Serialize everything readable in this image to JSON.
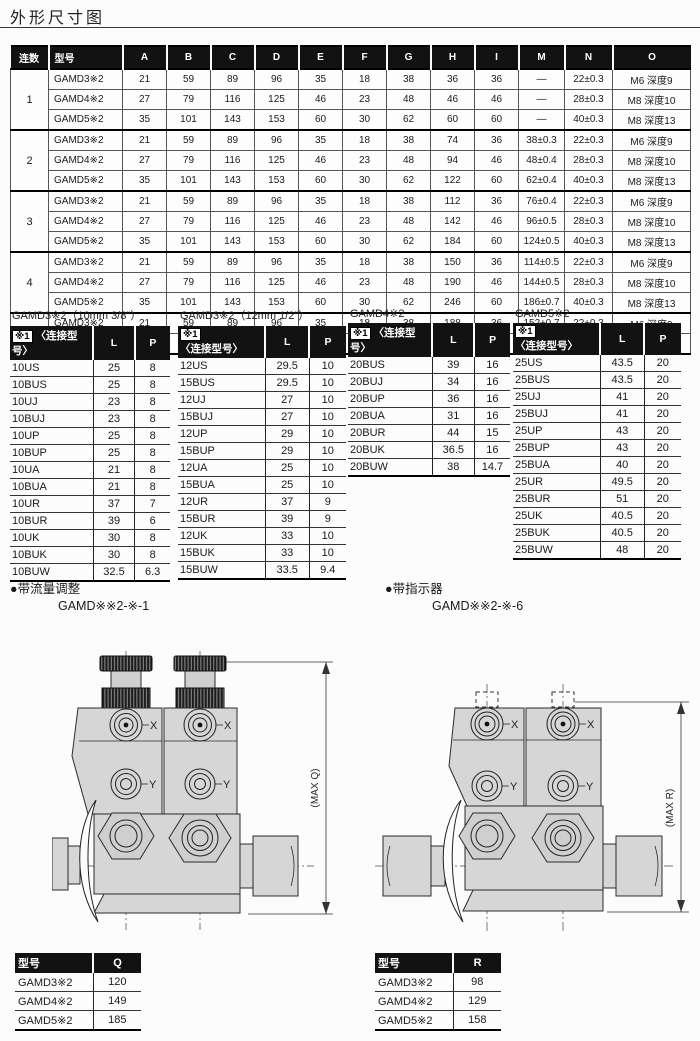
{
  "page": {
    "title": "外形尺寸图"
  },
  "main_table": {
    "headers": [
      "连数",
      "型号",
      "A",
      "B",
      "C",
      "D",
      "E",
      "F",
      "G",
      "H",
      "I",
      "M",
      "N",
      "O"
    ],
    "groups": [
      {
        "count": "1",
        "rows": [
          [
            "GAMD3※2",
            "21",
            "59",
            "89",
            "96",
            "35",
            "18",
            "38",
            "36",
            "36",
            "—",
            "22±0.3",
            "M6  深度9"
          ],
          [
            "GAMD4※2",
            "27",
            "79",
            "116",
            "125",
            "46",
            "23",
            "48",
            "46",
            "46",
            "—",
            "28±0.3",
            "M8  深度10"
          ],
          [
            "GAMD5※2",
            "35",
            "101",
            "143",
            "153",
            "60",
            "30",
            "62",
            "60",
            "60",
            "—",
            "40±0.3",
            "M8  深度13"
          ]
        ]
      },
      {
        "count": "2",
        "rows": [
          [
            "GAMD3※2",
            "21",
            "59",
            "89",
            "96",
            "35",
            "18",
            "38",
            "74",
            "36",
            "38±0.3",
            "22±0.3",
            "M6  深度9"
          ],
          [
            "GAMD4※2",
            "27",
            "79",
            "116",
            "125",
            "46",
            "23",
            "48",
            "94",
            "46",
            "48±0.4",
            "28±0.3",
            "M8  深度10"
          ],
          [
            "GAMD5※2",
            "35",
            "101",
            "143",
            "153",
            "60",
            "30",
            "62",
            "122",
            "60",
            "62±0.4",
            "40±0.3",
            "M8  深度13"
          ]
        ]
      },
      {
        "count": "3",
        "rows": [
          [
            "GAMD3※2",
            "21",
            "59",
            "89",
            "96",
            "35",
            "18",
            "38",
            "112",
            "36",
            "76±0.4",
            "22±0.3",
            "M6  深度9"
          ],
          [
            "GAMD4※2",
            "27",
            "79",
            "116",
            "125",
            "46",
            "23",
            "48",
            "142",
            "46",
            "96±0.5",
            "28±0.3",
            "M8  深度10"
          ],
          [
            "GAMD5※2",
            "35",
            "101",
            "143",
            "153",
            "60",
            "30",
            "62",
            "184",
            "60",
            "124±0.5",
            "40±0.3",
            "M8  深度13"
          ]
        ]
      },
      {
        "count": "4",
        "rows": [
          [
            "GAMD3※2",
            "21",
            "59",
            "89",
            "96",
            "35",
            "18",
            "38",
            "150",
            "36",
            "114±0.5",
            "22±0.3",
            "M6  深度9"
          ],
          [
            "GAMD4※2",
            "27",
            "79",
            "116",
            "125",
            "46",
            "23",
            "48",
            "190",
            "46",
            "144±0.5",
            "28±0.3",
            "M8  深度10"
          ],
          [
            "GAMD5※2",
            "35",
            "101",
            "143",
            "153",
            "60",
            "30",
            "62",
            "246",
            "60",
            "186±0.7",
            "40±0.3",
            "M8  深度13"
          ]
        ]
      },
      {
        "count": "5",
        "rows": [
          [
            "GAMD3※2",
            "21",
            "59",
            "89",
            "96",
            "35",
            "18",
            "38",
            "188",
            "36",
            "152±0.7",
            "22±0.3",
            "M6  深度9"
          ],
          [
            "GAMD4※2",
            "27",
            "79",
            "116",
            "125",
            "46",
            "23",
            "48",
            "238",
            "46",
            "192±0.7",
            "28±0.3",
            "M8  深度10"
          ]
        ]
      }
    ]
  },
  "sub_tables": [
    {
      "title": "GAMD3※2（10mm 3/8\"）",
      "ref": "※1",
      "header": "〈连接型号〉",
      "col_l": "L",
      "col_p": "P",
      "rows": [
        [
          "10US",
          "25",
          "8"
        ],
        [
          "10BUS",
          "25",
          "8"
        ],
        [
          "10UJ",
          "23",
          "8"
        ],
        [
          "10BUJ",
          "23",
          "8"
        ],
        [
          "10UP",
          "25",
          "8"
        ],
        [
          "10BUP",
          "25",
          "8"
        ],
        [
          "10UA",
          "21",
          "8"
        ],
        [
          "10BUA",
          "21",
          "8"
        ],
        [
          "10UR",
          "37",
          "7"
        ],
        [
          "10BUR",
          "39",
          "6"
        ],
        [
          "10UK",
          "30",
          "8"
        ],
        [
          "10BUK",
          "30",
          "8"
        ],
        [
          "10BUW",
          "32.5",
          "6.3"
        ]
      ]
    },
    {
      "title": "GAMD3※2（12mm 1/2\"）",
      "ref": "※1",
      "header": "〈连接型号〉",
      "col_l": "L",
      "col_p": "P",
      "rows": [
        [
          "12US",
          "29.5",
          "10"
        ],
        [
          "15BUS",
          "29.5",
          "10"
        ],
        [
          "12UJ",
          "27",
          "10"
        ],
        [
          "15BUJ",
          "27",
          "10"
        ],
        [
          "12UP",
          "29",
          "10"
        ],
        [
          "15BUP",
          "29",
          "10"
        ],
        [
          "12UA",
          "25",
          "10"
        ],
        [
          "15BUA",
          "25",
          "10"
        ],
        [
          "12UR",
          "37",
          "9"
        ],
        [
          "15BUR",
          "39",
          "9"
        ],
        [
          "12UK",
          "33",
          "10"
        ],
        [
          "15BUK",
          "33",
          "10"
        ],
        [
          "15BUW",
          "33.5",
          "9.4"
        ]
      ]
    },
    {
      "title": "GAMD4※2",
      "ref": "※1",
      "header": "〈连接型号〉",
      "col_l": "L",
      "col_p": "P",
      "rows": [
        [
          "20BUS",
          "39",
          "16"
        ],
        [
          "20BUJ",
          "34",
          "16"
        ],
        [
          "20BUP",
          "36",
          "16"
        ],
        [
          "20BUA",
          "31",
          "16"
        ],
        [
          "20BUR",
          "44",
          "15"
        ],
        [
          "20BUK",
          "36.5",
          "16"
        ],
        [
          "20BUW",
          "38",
          "14.7"
        ]
      ]
    },
    {
      "title": "GAMD5※2",
      "ref": "※1",
      "header": "〈连接型号〉",
      "col_l": "L",
      "col_p": "P",
      "rows": [
        [
          "25US",
          "43.5",
          "20"
        ],
        [
          "25BUS",
          "43.5",
          "20"
        ],
        [
          "25UJ",
          "41",
          "20"
        ],
        [
          "25BUJ",
          "41",
          "20"
        ],
        [
          "25UP",
          "43",
          "20"
        ],
        [
          "25BUP",
          "43",
          "20"
        ],
        [
          "25BUA",
          "40",
          "20"
        ],
        [
          "25UR",
          "49.5",
          "20"
        ],
        [
          "25BUR",
          "51",
          "20"
        ],
        [
          "25UK",
          "40.5",
          "20"
        ],
        [
          "25BUK",
          "40.5",
          "20"
        ],
        [
          "25BUW",
          "48",
          "20"
        ]
      ]
    }
  ],
  "variants": [
    {
      "bullet": "●",
      "label": "带流量调整",
      "model": "GAMD※※2-※-1",
      "dim_label": "(MAX Q)",
      "port_x": "X",
      "port_y": "Y",
      "table": {
        "headers": [
          "型号",
          "Q"
        ],
        "rows": [
          [
            "GAMD3※2",
            "120"
          ],
          [
            "GAMD4※2",
            "149"
          ],
          [
            "GAMD5※2",
            "185"
          ]
        ]
      }
    },
    {
      "bullet": "●",
      "label": "带指示器",
      "model": "GAMD※※2-※-6",
      "dim_label": "(MAX R)",
      "port_x": "X",
      "port_y": "Y",
      "table": {
        "headers": [
          "型号",
          "R"
        ],
        "rows": [
          [
            "GAMD3※2",
            "98"
          ],
          [
            "GAMD4※2",
            "129"
          ],
          [
            "GAMD5※2",
            "158"
          ]
        ]
      }
    }
  ]
}
